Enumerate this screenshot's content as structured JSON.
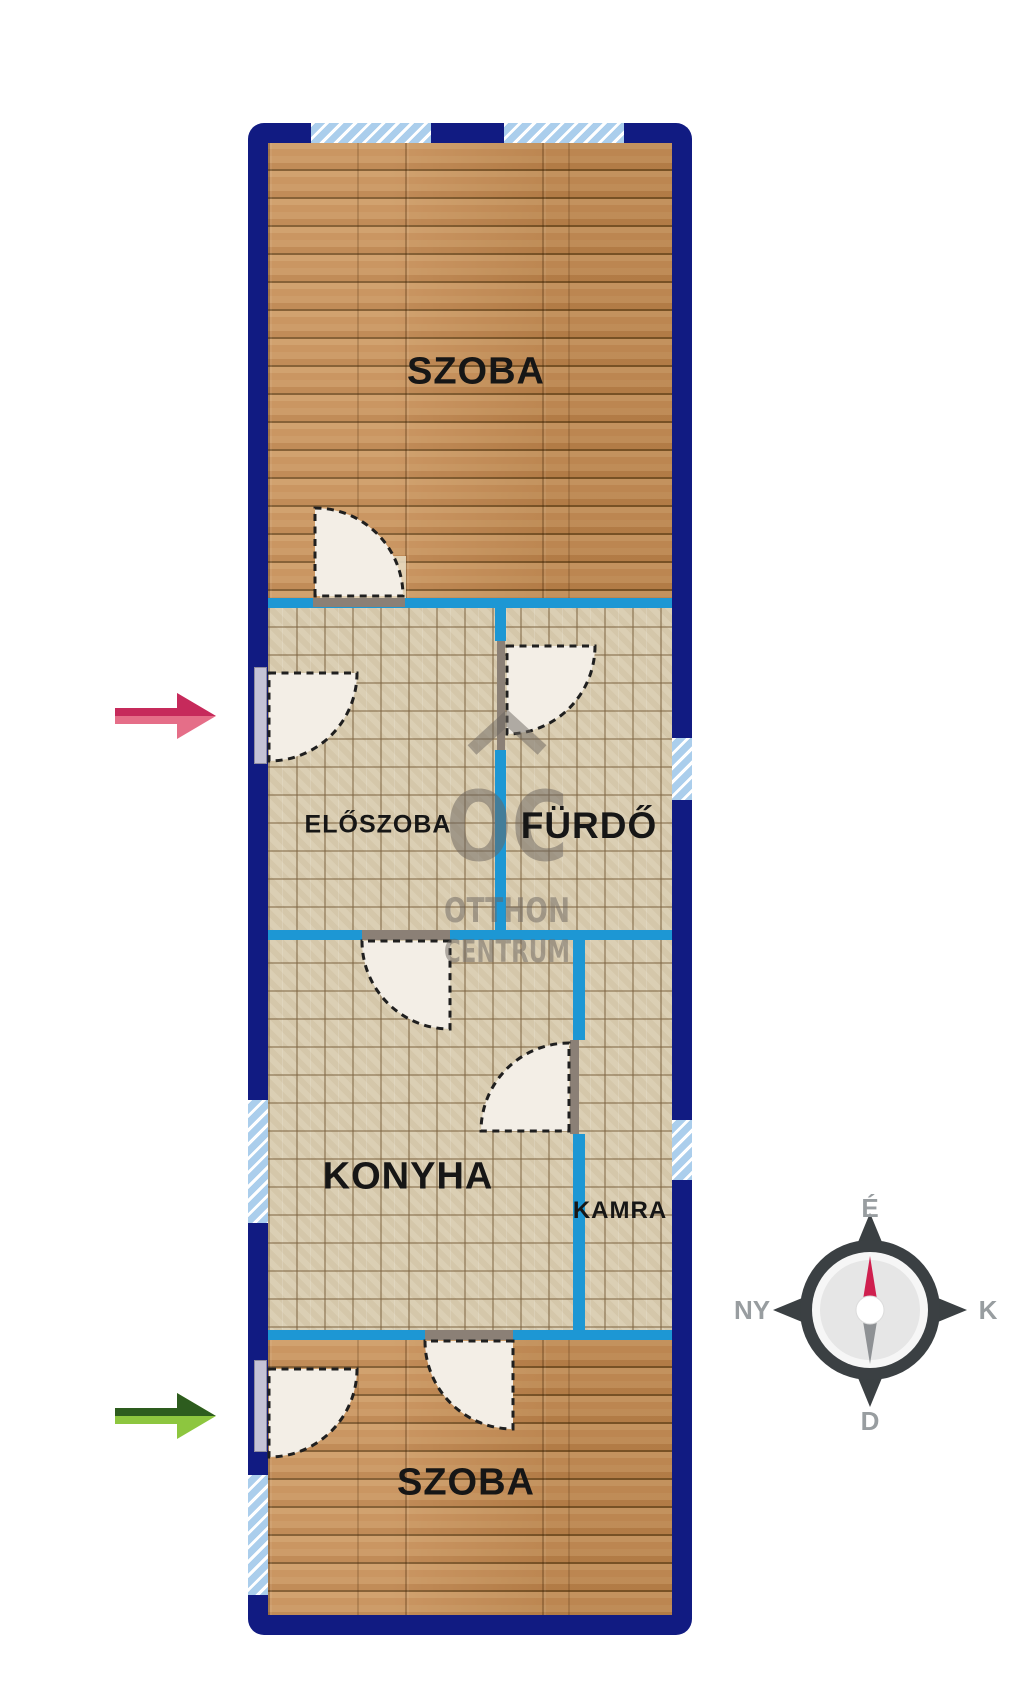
{
  "floorplan": {
    "rooms": [
      {
        "id": "szoba-top",
        "label": "SZOBA"
      },
      {
        "id": "eloszoba",
        "label": "ELŐSZOBA"
      },
      {
        "id": "furdo",
        "label": "FÜRDŐ"
      },
      {
        "id": "konyha",
        "label": "KONYHA"
      },
      {
        "id": "kamra",
        "label": "KAMRA"
      },
      {
        "id": "szoba-bottom",
        "label": "SZOBA"
      }
    ],
    "compass": {
      "north": "É",
      "west": "NY",
      "east": "K",
      "south": "D"
    },
    "watermark": {
      "logo": "OC",
      "name_line1": "OTTHON",
      "name_line2": "CENTRUM"
    },
    "colors": {
      "outer_wall": "#111b82",
      "inner_wall": "#1d97d4",
      "window_fill": "#abceec",
      "wood_floor": "#c08a52",
      "tile_floor": "#dbcfb4",
      "door_leaf": "#f3eee6",
      "door_frame": "#c5c3d6",
      "arrow_top_dark": "#c62a5b",
      "arrow_top_light": "#e56e88",
      "arrow_bottom_dark": "#2d5c1e",
      "arrow_bottom_light": "#8dc63f",
      "compass_body": "#3b4043",
      "compass_needle_north": "#cf1f4e",
      "compass_needle_south": "#8e9194",
      "label_text": "#161616"
    }
  }
}
